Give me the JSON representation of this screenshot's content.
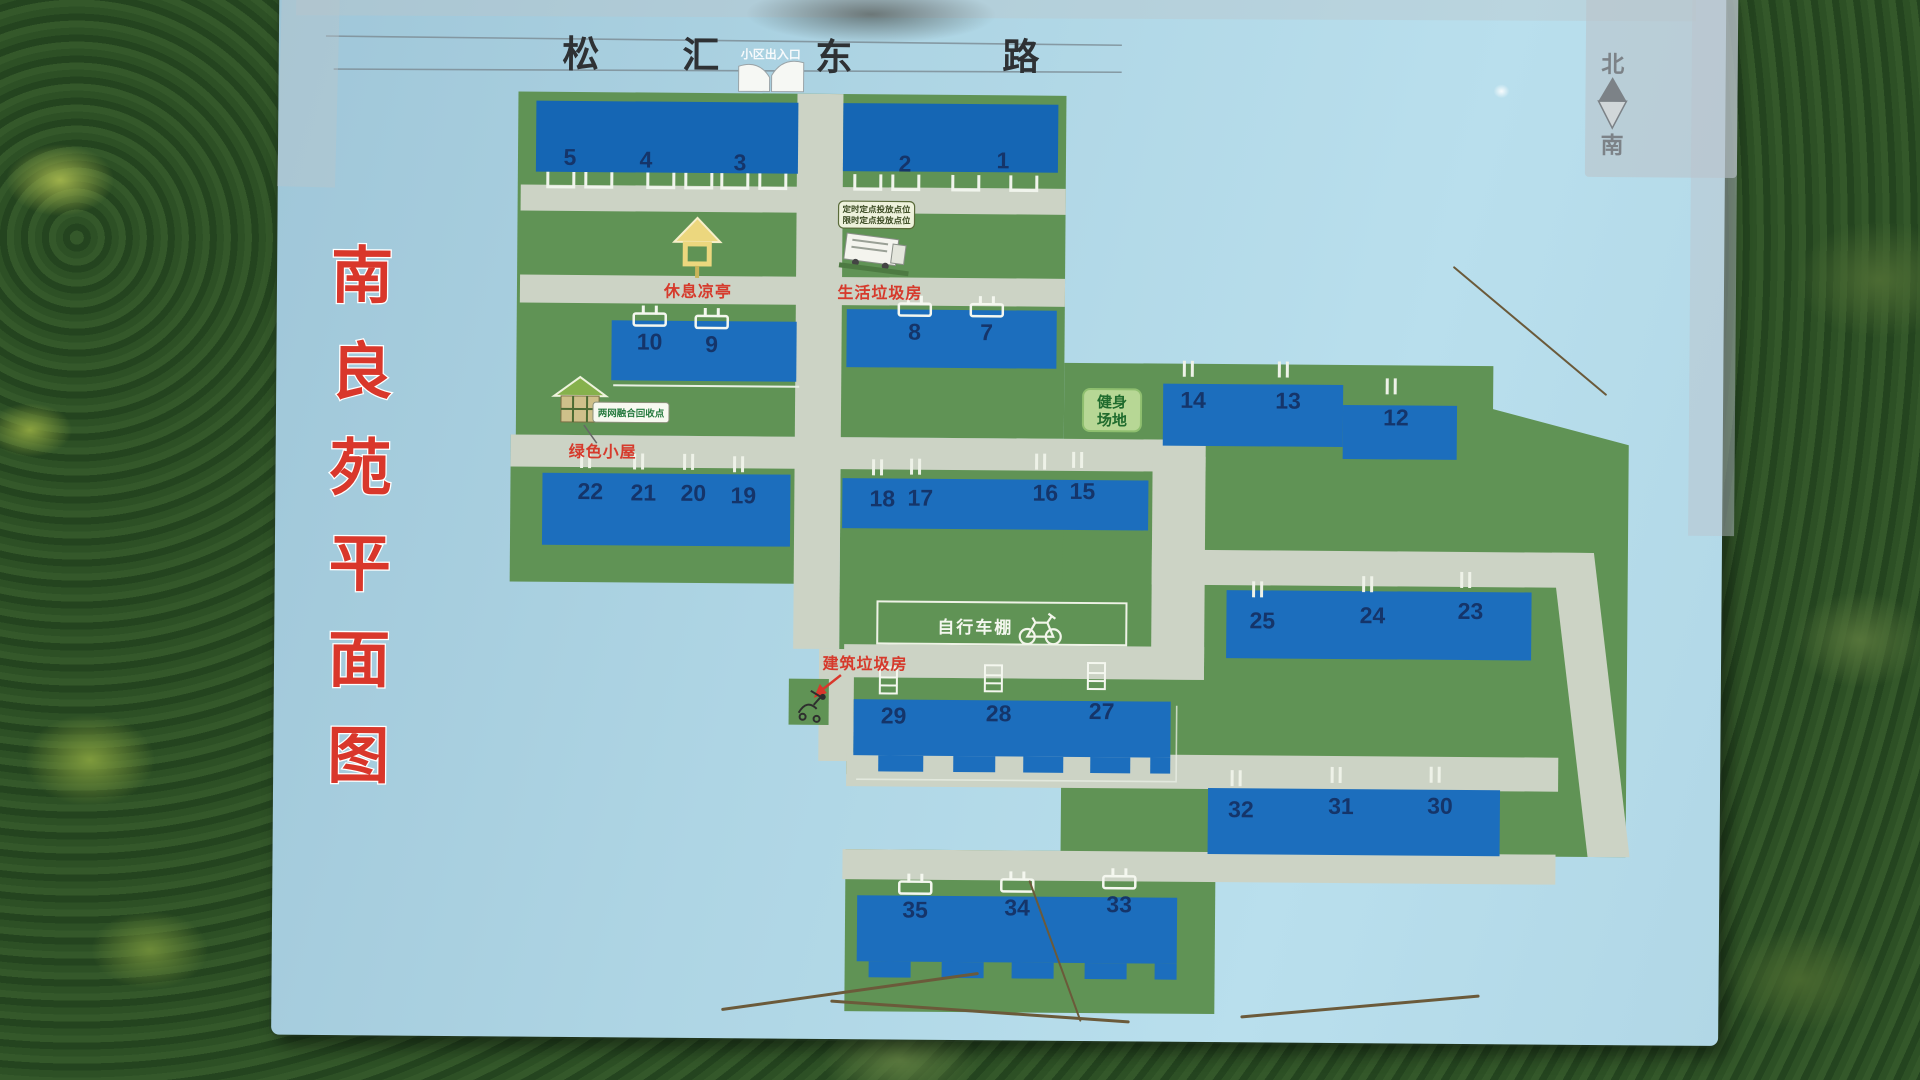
{
  "board": {
    "title": {
      "text": "南良苑平面图",
      "chars": [
        "南",
        "良",
        "苑",
        "平",
        "面",
        "图"
      ],
      "color": "#d9372b"
    },
    "road": {
      "name": "松汇东路",
      "chars": [
        "松",
        "汇",
        "东",
        "路"
      ]
    },
    "entrance": {
      "label": "小区出入口"
    },
    "compass": {
      "north": "北",
      "south": "南"
    }
  },
  "landmarks": {
    "pavilion_label": "休息凉亭",
    "domestic_waste_label": "生活垃圾房",
    "waste_sign_line1": "定时定点投放点位",
    "waste_sign_line2": "限时定点投放点位",
    "recycle_point_label": "两网融合回收点",
    "green_cabin_label": "绿色小屋",
    "fitness_line1": "健身",
    "fitness_line2": "场地",
    "bike_shed_label": "自行车棚",
    "construction_waste_label": "建筑垃圾房"
  },
  "buildings": [
    {
      "label": "5",
      "x": 567,
      "y": 168,
      "icon": "none"
    },
    {
      "label": "4",
      "x": 643,
      "y": 170,
      "icon": "none"
    },
    {
      "label": "3",
      "x": 737,
      "y": 172,
      "icon": "none"
    },
    {
      "label": "2",
      "x": 902,
      "y": 172,
      "icon": "none"
    },
    {
      "label": "1",
      "x": 1000,
      "y": 168,
      "icon": "none"
    },
    {
      "label": "10",
      "x": 648,
      "y": 352,
      "icon": "stool"
    },
    {
      "label": "9",
      "x": 710,
      "y": 354,
      "icon": "stool"
    },
    {
      "label": "8",
      "x": 913,
      "y": 340,
      "icon": "stool"
    },
    {
      "label": "7",
      "x": 985,
      "y": 340,
      "icon": "stool"
    },
    {
      "label": "14",
      "x": 1192,
      "y": 406,
      "icon": "ticks"
    },
    {
      "label": "13",
      "x": 1287,
      "y": 406,
      "icon": "ticks"
    },
    {
      "label": "12",
      "x": 1395,
      "y": 422,
      "icon": "ticks"
    },
    {
      "label": "22",
      "x": 590,
      "y": 502,
      "icon": "ticks"
    },
    {
      "label": "21",
      "x": 643,
      "y": 503,
      "icon": "ticks"
    },
    {
      "label": "20",
      "x": 693,
      "y": 503,
      "icon": "ticks"
    },
    {
      "label": "19",
      "x": 743,
      "y": 505,
      "icon": "ticks"
    },
    {
      "label": "18",
      "x": 882,
      "y": 507,
      "icon": "ticks"
    },
    {
      "label": "17",
      "x": 920,
      "y": 506,
      "icon": "ticks"
    },
    {
      "label": "16",
      "x": 1045,
      "y": 500,
      "icon": "ticks"
    },
    {
      "label": "15",
      "x": 1082,
      "y": 498,
      "icon": "ticks"
    },
    {
      "label": "25",
      "x": 1263,
      "y": 626,
      "icon": "ticks"
    },
    {
      "label": "24",
      "x": 1373,
      "y": 620,
      "icon": "ticks"
    },
    {
      "label": "23",
      "x": 1471,
      "y": 615,
      "icon": "ticks"
    },
    {
      "label": "29",
      "x": 895,
      "y": 724,
      "icon": "ladder"
    },
    {
      "label": "28",
      "x": 1000,
      "y": 721,
      "icon": "ladder"
    },
    {
      "label": "27",
      "x": 1103,
      "y": 718,
      "icon": "ladder"
    },
    {
      "label": "32",
      "x": 1243,
      "y": 815,
      "icon": "ticks"
    },
    {
      "label": "31",
      "x": 1343,
      "y": 811,
      "icon": "ticks"
    },
    {
      "label": "30",
      "x": 1442,
      "y": 810,
      "icon": "ticks"
    },
    {
      "label": "35",
      "x": 918,
      "y": 918,
      "icon": "stool"
    },
    {
      "label": "34",
      "x": 1020,
      "y": 915,
      "icon": "stool"
    },
    {
      "label": "33",
      "x": 1122,
      "y": 911,
      "icon": "stool"
    }
  ],
  "colors": {
    "board_blue": "#aed5e4",
    "land_green": "#609355",
    "road_gray": "#ccd3c5",
    "building_blue": "#1c6ebd",
    "number_navy": "#15356a",
    "label_red": "#d63a2c"
  }
}
